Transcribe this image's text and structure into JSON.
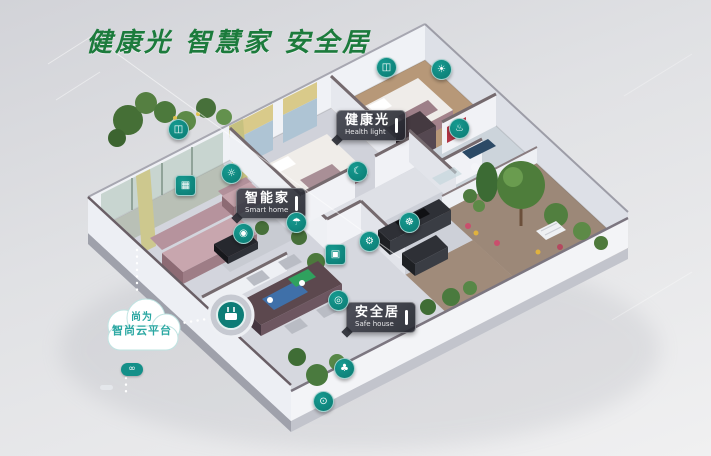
{
  "page": {
    "background_top": "#d2d3d8",
    "background_bottom": "#f0f0f1"
  },
  "title": {
    "text": "健康光 智慧家 安全居",
    "color": "#1c7b3c"
  },
  "cloud": {
    "line1": "尚为",
    "line2": "智尚云平台",
    "text_color": "#2aa7a2"
  },
  "link_badge": {
    "glyph": "∞"
  },
  "tags": [
    {
      "zh": "健康光",
      "en": "Health light"
    },
    {
      "zh": "智能家",
      "en": "Smart home"
    },
    {
      "zh": "安全居",
      "en": "Safe house"
    }
  ],
  "icons": [
    {
      "type": "curtain-bedroom",
      "glyph": "◫"
    },
    {
      "type": "ceiling-light",
      "glyph": "☀"
    },
    {
      "type": "curtain-living",
      "glyph": "◫"
    },
    {
      "type": "wall-light",
      "glyph": "☼"
    },
    {
      "type": "scene-panel",
      "glyph": "▦"
    },
    {
      "type": "floor-lamp",
      "glyph": "◉"
    },
    {
      "type": "bed-sensor",
      "glyph": "☾"
    },
    {
      "type": "humidity-sensor",
      "glyph": "☂"
    },
    {
      "type": "exhaust-fan",
      "glyph": "☸"
    },
    {
      "type": "gas-valve",
      "glyph": "⚙"
    },
    {
      "type": "door-window-sensor",
      "glyph": "▣"
    },
    {
      "type": "water-heater",
      "glyph": "♨"
    },
    {
      "type": "motion-sensor",
      "glyph": "◎"
    },
    {
      "type": "irrigation-sensor",
      "glyph": "♣"
    },
    {
      "type": "video-doorbell",
      "glyph": "⊙"
    }
  ],
  "colors": {
    "device_teal": "#0d8a80",
    "tag_background": "rgba(40,42,50,0.9)",
    "title_green": "#1c7b3c",
    "cloud_teal": "#2aa7a2"
  }
}
